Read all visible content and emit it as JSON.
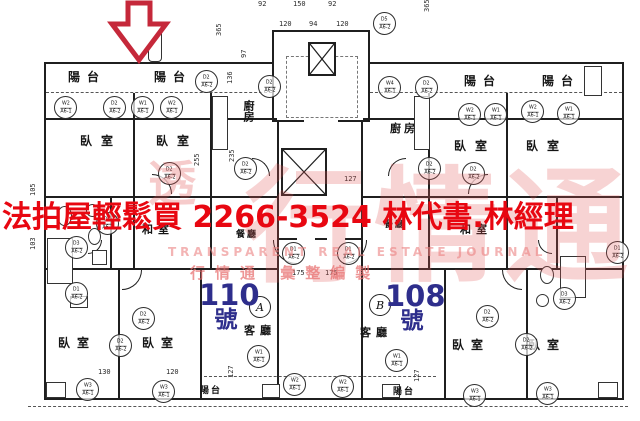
{
  "page": {
    "background": "#ffffff",
    "ink_color": "#1f1f1f",
    "type": "scanned floor plan flyer"
  },
  "arrow": {
    "name": "red-down-arrow",
    "color": "#c5283a"
  },
  "headline": {
    "text": "法拍屋輕鬆買  2266-3524  林代書.林經理",
    "color": "#e80711"
  },
  "watermark": {
    "big_text": "行情通",
    "corner_char": "透",
    "line_en": "TRANSPARENT REAL ESTATE JOURNAL",
    "line_cn": "行情通  彙整編製",
    "color": "#e05454"
  },
  "units": [
    {
      "label": "A",
      "number": "110",
      "suffix": "號",
      "color": "#2e2e8c"
    },
    {
      "label": "B",
      "number": "108",
      "suffix": "號",
      "color": "#2e2e8c"
    }
  ],
  "legend": {
    "balcony": "陽台",
    "bedroom": "臥室",
    "kitchen": "廚房",
    "dining": "餐廳",
    "tatami": "和室",
    "living": "客廳"
  },
  "room_labels": [
    {
      "t": "陽台",
      "x": 68,
      "y": 68,
      "s": 12,
      "ls": 7
    },
    {
      "t": "陽台",
      "x": 154,
      "y": 68,
      "s": 12,
      "ls": 7
    },
    {
      "t": "陽台",
      "x": 464,
      "y": 72,
      "s": 12,
      "ls": 7
    },
    {
      "t": "陽台",
      "x": 542,
      "y": 72,
      "s": 12,
      "ls": 7
    },
    {
      "t": "臥室",
      "x": 80,
      "y": 132,
      "s": 12,
      "ls": 9
    },
    {
      "t": "臥室",
      "x": 156,
      "y": 132,
      "s": 12,
      "ls": 9
    },
    {
      "t": "臥室",
      "x": 454,
      "y": 137,
      "s": 12,
      "ls": 9
    },
    {
      "t": "臥室",
      "x": 526,
      "y": 137,
      "s": 12,
      "ls": 9
    },
    {
      "t": "廚房",
      "x": 240,
      "y": 100,
      "s": 11,
      "ls": 0,
      "v": 1
    },
    {
      "t": "廚房",
      "x": 390,
      "y": 120,
      "s": 11,
      "ls": 3
    },
    {
      "t": "和室",
      "x": 142,
      "y": 221,
      "s": 11,
      "ls": 5
    },
    {
      "t": "和室",
      "x": 460,
      "y": 221,
      "s": 11,
      "ls": 5
    },
    {
      "t": "餐廳",
      "x": 236,
      "y": 227,
      "s": 9,
      "ls": 2
    },
    {
      "t": "餐廳",
      "x": 384,
      "y": 217,
      "s": 9,
      "ls": 2
    },
    {
      "t": "客廳",
      "x": 244,
      "y": 322,
      "s": 11,
      "ls": 5
    },
    {
      "t": "客廳",
      "x": 360,
      "y": 324,
      "s": 11,
      "ls": 5
    },
    {
      "t": "臥室",
      "x": 58,
      "y": 334,
      "s": 12,
      "ls": 7
    },
    {
      "t": "臥室",
      "x": 142,
      "y": 334,
      "s": 12,
      "ls": 7
    },
    {
      "t": "臥室",
      "x": 452,
      "y": 336,
      "s": 12,
      "ls": 7
    },
    {
      "t": "臥室",
      "x": 528,
      "y": 336,
      "s": 12,
      "ls": 7
    },
    {
      "t": "陽台",
      "x": 200,
      "y": 383,
      "s": 9,
      "ls": 2
    },
    {
      "t": "陽台",
      "x": 393,
      "y": 384,
      "s": 9,
      "ls": 2
    }
  ],
  "dimensions": [
    {
      "t": "92",
      "x": 258,
      "y": 1
    },
    {
      "t": "150",
      "x": 293,
      "y": 1
    },
    {
      "t": "92",
      "x": 328,
      "y": 1
    },
    {
      "t": "120",
      "x": 279,
      "y": 21
    },
    {
      "t": "94",
      "x": 309,
      "y": 21
    },
    {
      "t": "120",
      "x": 336,
      "y": 21
    },
    {
      "t": "365",
      "x": 216,
      "y": 36,
      "r": 1
    },
    {
      "t": "97",
      "x": 241,
      "y": 58,
      "r": 1
    },
    {
      "t": "136",
      "x": 227,
      "y": 84,
      "r": 1
    },
    {
      "t": "365",
      "x": 424,
      "y": 12,
      "r": 1
    },
    {
      "t": "255",
      "x": 194,
      "y": 166,
      "r": 1
    },
    {
      "t": "235",
      "x": 229,
      "y": 162,
      "r": 1
    },
    {
      "t": "127",
      "x": 344,
      "y": 176
    },
    {
      "t": "175",
      "x": 292,
      "y": 270
    },
    {
      "t": "175",
      "x": 325,
      "y": 270
    },
    {
      "t": "105",
      "x": 30,
      "y": 196,
      "r": 1
    },
    {
      "t": "103",
      "x": 30,
      "y": 250,
      "r": 1
    },
    {
      "t": "127",
      "x": 228,
      "y": 378,
      "r": 1
    },
    {
      "t": "127",
      "x": 414,
      "y": 382,
      "r": 1
    },
    {
      "t": "130",
      "x": 98,
      "y": 369
    },
    {
      "t": "120",
      "x": 166,
      "y": 369
    }
  ],
  "markers": [
    {
      "x": 64,
      "y": 106,
      "a": "W2",
      "b": "A6-1"
    },
    {
      "x": 113,
      "y": 106,
      "a": "D2",
      "b": "A6-2"
    },
    {
      "x": 141,
      "y": 106,
      "a": "W1",
      "b": "A6-1"
    },
    {
      "x": 170,
      "y": 106,
      "a": "W2",
      "b": "A6-1"
    },
    {
      "x": 205,
      "y": 80,
      "a": "D2",
      "b": "A6-2"
    },
    {
      "x": 268,
      "y": 85,
      "a": "D2",
      "b": "A6-2"
    },
    {
      "x": 388,
      "y": 86,
      "a": "W4",
      "b": "A6-1"
    },
    {
      "x": 425,
      "y": 86,
      "a": "D2",
      "b": "A6-2"
    },
    {
      "x": 383,
      "y": 22,
      "a": "D5",
      "b": "A6-2"
    },
    {
      "x": 468,
      "y": 113,
      "a": "W2",
      "b": "A6-1"
    },
    {
      "x": 494,
      "y": 113,
      "a": "W1",
      "b": "A6-1"
    },
    {
      "x": 531,
      "y": 110,
      "a": "W2",
      "b": "A6-1"
    },
    {
      "x": 567,
      "y": 112,
      "a": "W1",
      "b": "A6-1"
    },
    {
      "x": 168,
      "y": 172,
      "a": "D2",
      "b": "A6-2"
    },
    {
      "x": 472,
      "y": 172,
      "a": "D2",
      "b": "A6-2"
    },
    {
      "x": 244,
      "y": 167,
      "a": "D2",
      "b": "A6-2"
    },
    {
      "x": 428,
      "y": 167,
      "a": "D2",
      "b": "A6-2"
    },
    {
      "x": 106,
      "y": 222,
      "a": "D1",
      "b": "A6-2"
    },
    {
      "x": 75,
      "y": 246,
      "a": "D3",
      "b": "A6-2"
    },
    {
      "x": 75,
      "y": 292,
      "a": "D1",
      "b": "A6-2"
    },
    {
      "x": 563,
      "y": 297,
      "a": "D3",
      "b": "A6-2"
    },
    {
      "x": 616,
      "y": 251,
      "a": "D1",
      "b": "A6-2"
    },
    {
      "x": 292,
      "y": 252,
      "a": "D1",
      "b": "A6-2"
    },
    {
      "x": 347,
      "y": 252,
      "a": "D1",
      "b": "A6-2"
    },
    {
      "x": 142,
      "y": 317,
      "a": "D2",
      "b": "A6-2"
    },
    {
      "x": 119,
      "y": 344,
      "a": "D2",
      "b": "A6-2"
    },
    {
      "x": 486,
      "y": 315,
      "a": "D2",
      "b": "A6-2"
    },
    {
      "x": 525,
      "y": 343,
      "a": "D2",
      "b": "A6-2"
    },
    {
      "x": 86,
      "y": 388,
      "a": "W3",
      "b": "A6-1"
    },
    {
      "x": 162,
      "y": 390,
      "a": "W3",
      "b": "A6-1"
    },
    {
      "x": 257,
      "y": 355,
      "a": "W1",
      "b": "A6-1"
    },
    {
      "x": 293,
      "y": 383,
      "a": "W2",
      "b": "A6-1"
    },
    {
      "x": 341,
      "y": 385,
      "a": "W2",
      "b": "A6-1"
    },
    {
      "x": 395,
      "y": 359,
      "a": "W1",
      "b": "A6-1"
    },
    {
      "x": 473,
      "y": 394,
      "a": "W3",
      "b": "A6-1"
    },
    {
      "x": 546,
      "y": 392,
      "a": "W3",
      "b": "A6-1"
    }
  ]
}
